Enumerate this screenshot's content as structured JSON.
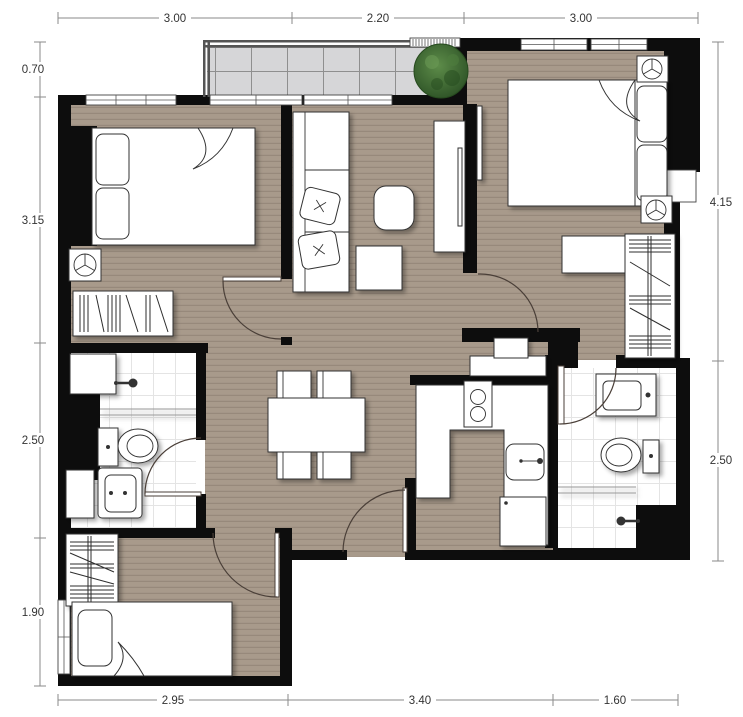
{
  "dimensions": {
    "top": [
      "3.00",
      "2.20",
      "3.00"
    ],
    "left": [
      "0.70",
      "3.15",
      "2.50",
      "1.90"
    ],
    "right": [
      "4.15",
      "2.50"
    ],
    "bottom": [
      "2.95",
      "3.40",
      "1.60"
    ]
  },
  "colors": {
    "background": "#ffffff",
    "wall": "#0d0d0d",
    "floor": "#a89a8b",
    "floor_stripe": "#97897b",
    "balcony_tile": "#d6d6d8",
    "balcony_grid": "#8f8f8f",
    "bath_floor": "#ffffff",
    "bath_grid": "#e4e4e4",
    "furniture_fill": "#ffffff",
    "furniture_line": "#333333",
    "door_arc": "#4a3f38",
    "dimension_line": "#8a8a8a",
    "dimension_text": "#333333",
    "plant_light": "#5d8c49",
    "plant_dark": "#2d5226"
  },
  "icons": {
    "ac": "ac-unit-icon",
    "plant": "plant-icon",
    "shower": "shower-head-icon"
  }
}
